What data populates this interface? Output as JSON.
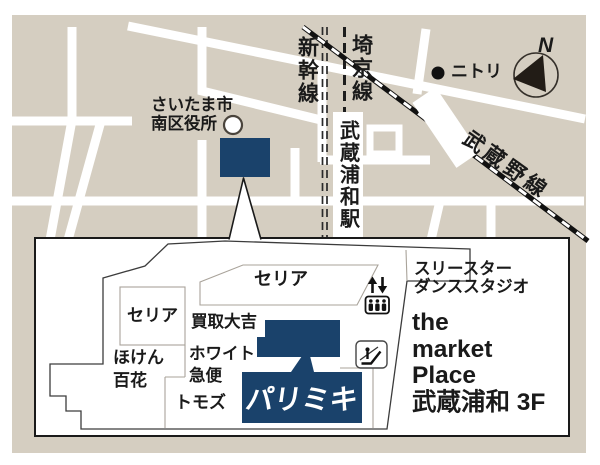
{
  "map": {
    "ward_office": [
      "さいたま市",
      "南区役所"
    ],
    "shinkansen": "新幹線",
    "saikyo": "埼京線",
    "station": "武蔵浦和駅",
    "musashino": "武蔵野線",
    "nitori": "ニトリ",
    "compass_n": "N"
  },
  "floor": {
    "seria_top": "セリア",
    "seria_left": "セリア",
    "kaitori_daikichi": "買取大吉",
    "white_kyubin": [
      "ホワイト",
      "急便"
    ],
    "hoken_hyakka": [
      "ほけん",
      "百花"
    ],
    "tomods": "トモズ",
    "paris_miki": "パリミキ",
    "dance_studio": [
      "スリースター",
      "ダンススタジオ"
    ],
    "building_name": [
      "the",
      "market",
      "Place",
      "武蔵浦和 3F"
    ]
  },
  "icons": [
    "north-compass-icon",
    "nitori-dot-icon",
    "ward-office-circle-icon",
    "elevator-icon",
    "escalator-icon",
    "location-marker",
    "callout-pointer"
  ],
  "colors": {
    "navy": "#1a426b",
    "beige": "#d5cec1",
    "road": "#ffffff",
    "text": "#1a1a1a"
  }
}
